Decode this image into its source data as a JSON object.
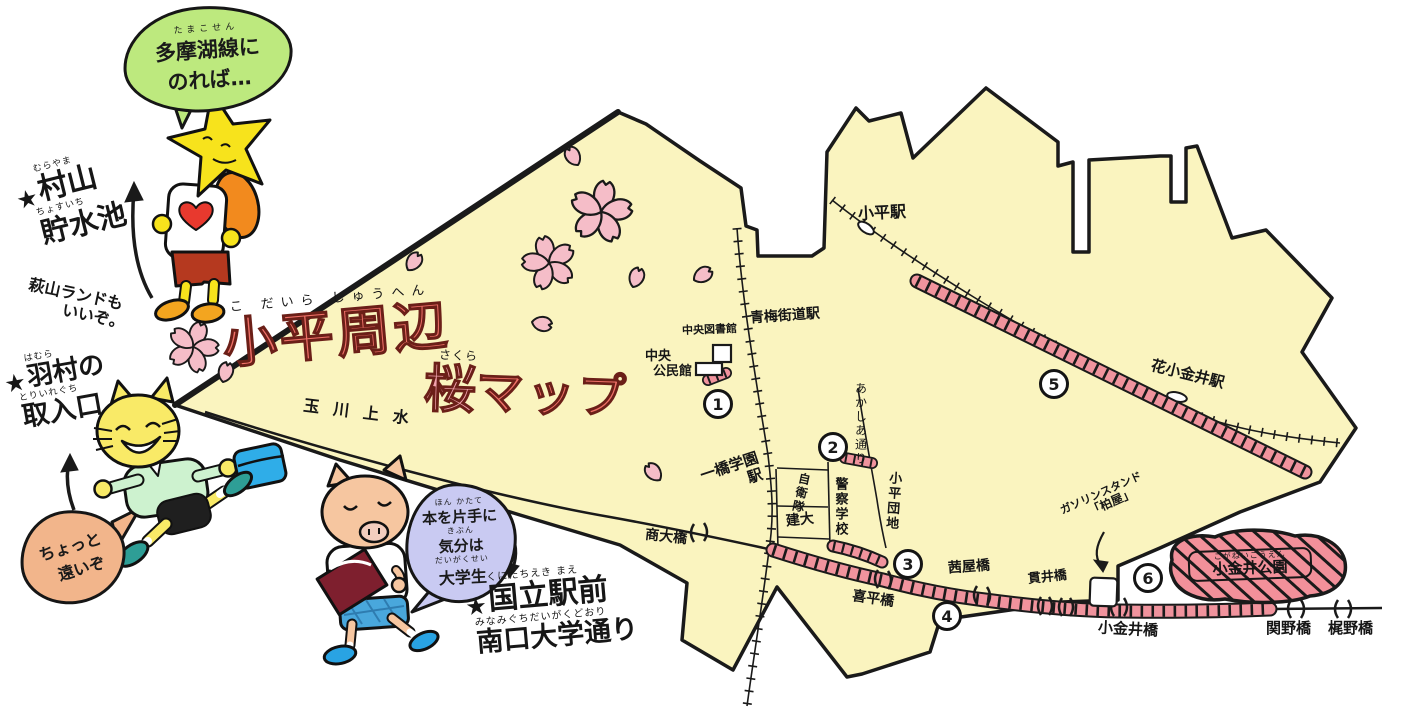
{
  "colors": {
    "map_fill": "#FAF4BF",
    "sakura_band_pink": "#F0939D",
    "park_pink": "#F2909A",
    "petal_pink": "#F5BDC8",
    "title_red": "#EF7168",
    "title_pink": "#F2A3AD",
    "bubble_green": "#BDE97E",
    "bubble_orange": "#F2B58B",
    "bubble_purple": "#C9CAF2",
    "cat_yellow": "#F9EA67",
    "star_boy_yellow": "#F7E31C",
    "pig_pink": "#F6C6A0"
  },
  "title": {
    "furigana_top": "こ だいら しゅうへん",
    "line1": "小平周辺",
    "furigana_sakura": "さくら",
    "sakura": "桜",
    "map_word": "マップ"
  },
  "bubbles": {
    "tamako": {
      "furigana": "たまこせん",
      "line1": "多摩湖線に",
      "line2": "のれば…"
    },
    "tooi": {
      "line1": "ちょっと",
      "line2": "遠いぞ"
    },
    "pig": {
      "furigana1": "ほん かたて",
      "line1": "本を片手に",
      "furigana2": "きぶん",
      "line2": "気分は",
      "furigana3": "だいがくせい",
      "line3": "大学生"
    }
  },
  "annotations": {
    "murayama": {
      "star": "★",
      "furigana1": "むらやま",
      "line1": "村山",
      "furigana2": "ちょすいち",
      "line2": "貯水池"
    },
    "hagiyama": {
      "line1": "萩山ランドも",
      "line2": "いいぞ。"
    },
    "hamura": {
      "star": "★",
      "furigana1": "はむら",
      "line1": "羽村の",
      "furigana2": "とりいれぐち",
      "line2": "取入口"
    },
    "kunitachi": {
      "star": "★",
      "furigana1": "くにたちえき まえ",
      "line1": "国立駅前",
      "furigana2": "みなみぐちだいがくどおり",
      "line2": "南口大学通り"
    }
  },
  "map_labels": {
    "kodaira_station": "小平駅",
    "oume_kaido_station": "青梅街道駅",
    "chuo_library": "中央図書館",
    "chuo_kominkan_1": "中央",
    "chuo_kominkan_2": "公民館",
    "akashia_dori": "あかしあ通り",
    "hitotsubashi_gakuen_1": "一橋学園",
    "hitotsubashi_gakuen_2": "駅",
    "jieitai": "自衛隊",
    "kendai": "建大",
    "keisatsu_gakko": "警察学校",
    "kodaira_danchi": "小平団地",
    "tamagawa_josui": "玉川上水",
    "shodai_bashi": "商大橋",
    "kihei_bashi": "喜平橋",
    "akaneya_bashi": "茜屋橋",
    "nukui_bashi": "貫井橋",
    "gas_station_1": "ガソリンスタンド",
    "gas_station_2": "「柏屋」",
    "koganei_bashi": "小金井橋",
    "hana_koganei_station": "花小金井駅",
    "koganei_park_furigana": "こがねいこうえん",
    "koganei_park": "小金井公園",
    "sekino_bashi": "関野橋",
    "kajino_bashi": "梶野橋"
  },
  "spot_numbers": [
    "1",
    "2",
    "3",
    "4",
    "5",
    "6"
  ]
}
